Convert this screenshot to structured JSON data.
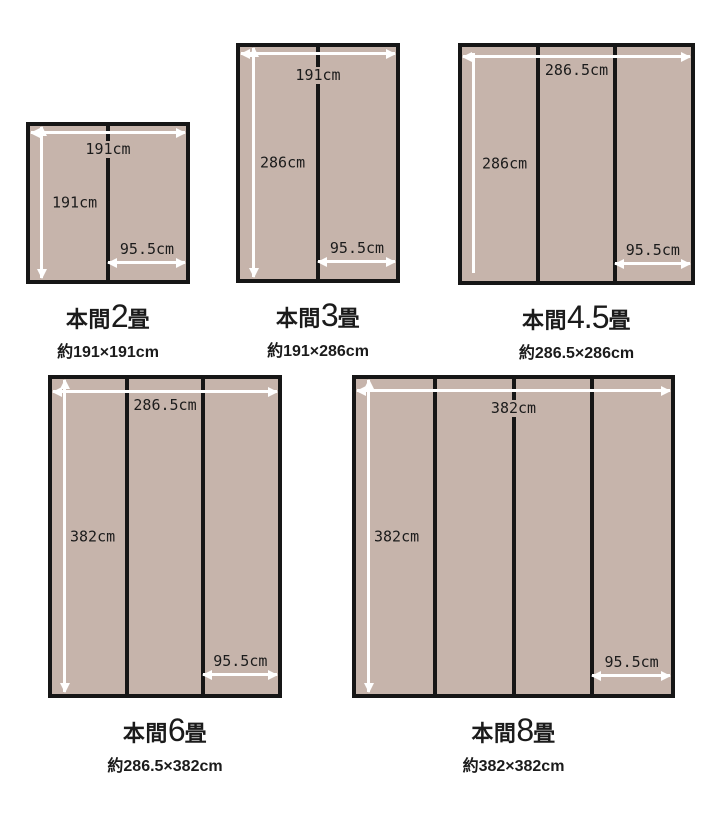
{
  "colors": {
    "background": "#ffffff",
    "mat_fill": "#c6b4ab",
    "line": "#161616",
    "arrow": "#ffffff",
    "text": "#1b1b1b"
  },
  "diagrams": [
    {
      "name": "honma-2jo",
      "title_prefix": "本間",
      "title_number": "2",
      "title_suffix": "畳",
      "subtitle": "約191×191cm",
      "width_label": "191cm",
      "height_label": "191cm",
      "mat_width_label": "95.5cm",
      "columns": 2,
      "geometry": {
        "left": 26,
        "top": 122,
        "width": 164,
        "height": 162,
        "h_arrow_top": 5,
        "v_arrow_left": 10,
        "v_arrow_heads": true,
        "width_label_top": 15,
        "height_label_left": 20,
        "mat_arrow_bottom": 16,
        "mat_label_bottom": 22
      }
    },
    {
      "name": "honma-3jo",
      "title_prefix": "本間",
      "title_number": "3",
      "title_suffix": "畳",
      "subtitle": "約191×286cm",
      "width_label": "191cm",
      "height_label": "286cm",
      "mat_width_label": "95.5cm",
      "columns": 2,
      "geometry": {
        "left": 236,
        "top": 43,
        "width": 164,
        "height": 240,
        "h_arrow_top": 5,
        "v_arrow_left": 12,
        "v_arrow_heads": true,
        "width_label_top": 20,
        "height_label_left": 18,
        "mat_arrow_bottom": 16,
        "mat_label_bottom": 22
      }
    },
    {
      "name": "honma-4-5jo",
      "title_prefix": "本間",
      "title_number": "4.5",
      "title_suffix": "畳",
      "subtitle": "約286.5×286cm",
      "width_label": "286.5cm",
      "height_label": "286cm",
      "mat_width_label": "95.5cm",
      "columns": 3,
      "geometry": {
        "left": 458,
        "top": 43,
        "width": 237,
        "height": 242,
        "h_arrow_top": 8,
        "v_arrow_left": 10,
        "v_arrow_heads": false,
        "v_inset_top": 6,
        "v_inset_bottom": 8,
        "width_label_top": 15,
        "height_label_left": 18,
        "mat_arrow_bottom": 16,
        "mat_label_bottom": 22
      }
    },
    {
      "name": "honma-6jo",
      "title_prefix": "本間",
      "title_number": "6",
      "title_suffix": "畳",
      "subtitle": "約286.5×382cm",
      "width_label": "286.5cm",
      "height_label": "382cm",
      "mat_width_label": "95.5cm",
      "columns": 3,
      "geometry": {
        "left": 48,
        "top": 375,
        "width": 234,
        "height": 323,
        "h_arrow_top": 11,
        "v_arrow_left": 11,
        "v_arrow_heads": true,
        "width_label_top": 18,
        "height_label_left": 16,
        "mat_arrow_bottom": 18,
        "mat_label_bottom": 24
      }
    },
    {
      "name": "honma-8jo",
      "title_prefix": "本間",
      "title_number": "8",
      "title_suffix": "畳",
      "subtitle": "約382×382cm",
      "width_label": "382cm",
      "height_label": "382cm",
      "mat_width_label": "95.5cm",
      "columns": 4,
      "geometry": {
        "left": 352,
        "top": 375,
        "width": 323,
        "height": 323,
        "h_arrow_top": 10,
        "v_arrow_left": 11,
        "v_arrow_heads": true,
        "width_label_top": 21,
        "height_label_left": 16,
        "mat_arrow_bottom": 17,
        "mat_label_bottom": 23
      }
    }
  ],
  "caption_gap": 13
}
